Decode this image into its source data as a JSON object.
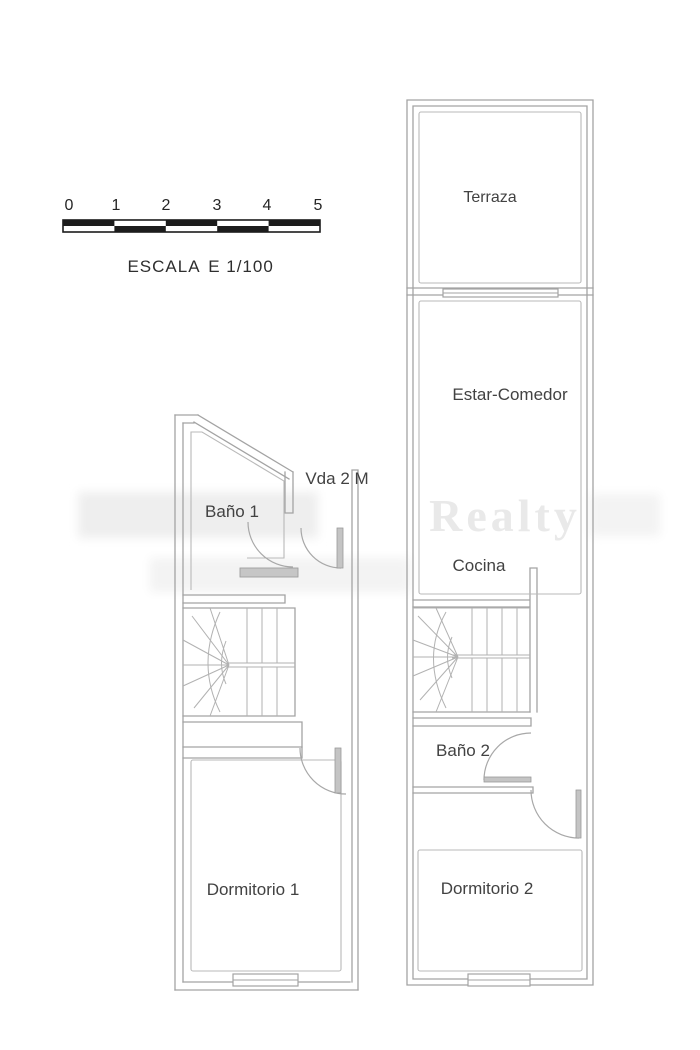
{
  "scale_bar": {
    "numbers": [
      "0",
      "1",
      "2",
      "3",
      "4",
      "5"
    ],
    "caption_left": "ESCALA",
    "caption_right": "E 1/100"
  },
  "main_floor_plan": {
    "rooms": [
      {
        "label": "Terraza"
      },
      {
        "label": "Estar-Comedor"
      },
      {
        "label": "Cocina"
      },
      {
        "label": "Baño 2"
      },
      {
        "label": "Dormitorio 2"
      }
    ]
  },
  "upper_floor_plan": {
    "annotation": "Vda 2 M",
    "rooms": [
      {
        "label": "Baño 1"
      },
      {
        "label": "Dormitorio 1"
      }
    ]
  },
  "watermark": {
    "text": "Realty"
  },
  "colors": {
    "background": "#ffffff",
    "wall_line": "#a3a3a3",
    "label_text": "#424242",
    "scale_bar": "#1c1c1c",
    "watermark": "#e9e9e9"
  }
}
